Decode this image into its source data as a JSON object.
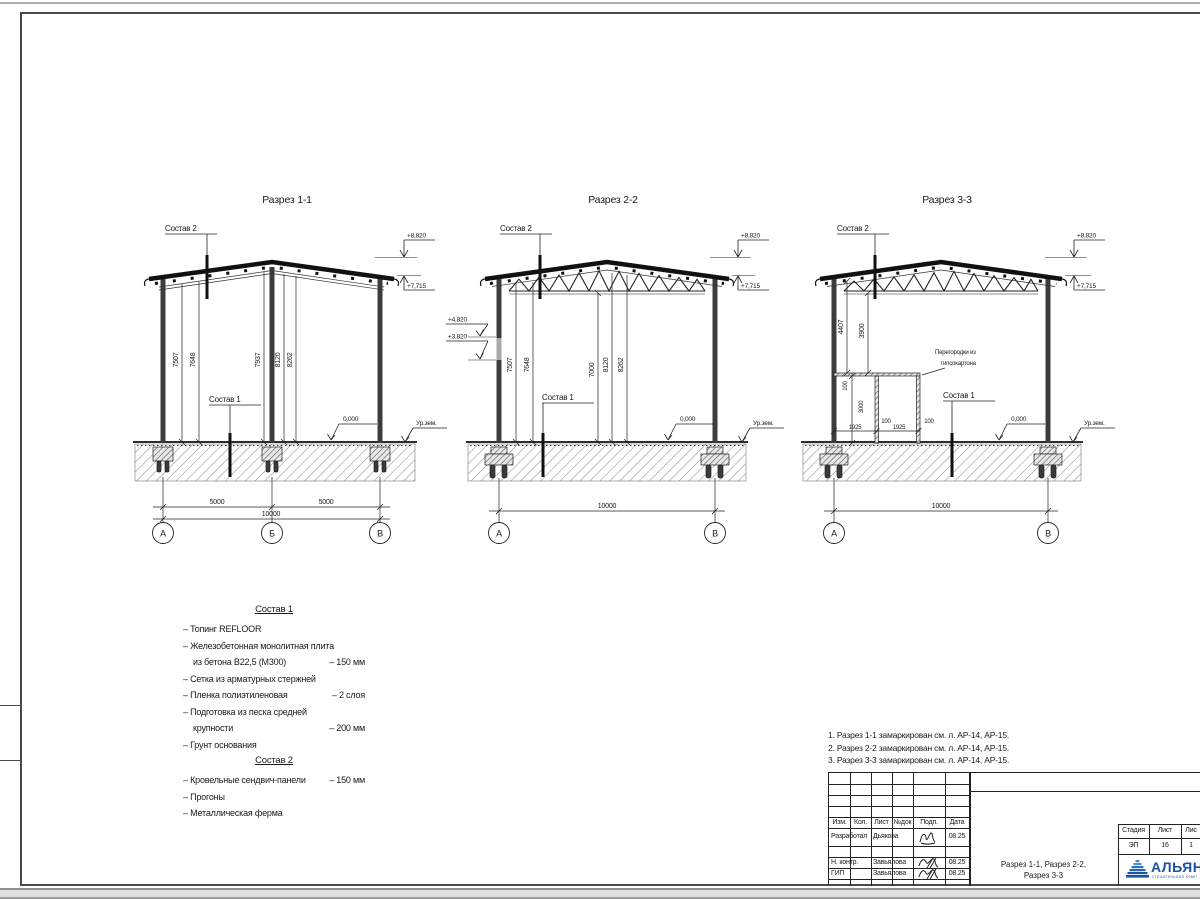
{
  "sheet": {
    "sections": [
      {
        "title": "Разрез 1-1",
        "sostav2": "Состав 2",
        "sostav1": "Состав 1",
        "elev_ridge": "+8,820",
        "elev_eave": "+7,715",
        "elev_floor": "0,000",
        "ground": "Ур.зем.",
        "vdims": [
          "7507",
          "7648",
          "7937",
          "8120",
          "8262"
        ],
        "spans": [
          "5000",
          "5000"
        ],
        "total": "10000",
        "axes": [
          "А",
          "Б",
          "В"
        ]
      },
      {
        "title": "Разрез 2-2",
        "sostav2": "Состав 2",
        "sostav1": "Состав 1",
        "elev_ridge": "+8,820",
        "elev_eave": "+7,715",
        "elev_win_top": "+4,820",
        "elev_win_bot": "+3,820",
        "elev_floor": "0,000",
        "ground": "Ур.зем.",
        "vdims": [
          "7507",
          "7648",
          "7000",
          "8120",
          "8262"
        ],
        "total": "10000",
        "axes": [
          "А",
          "В"
        ]
      },
      {
        "title": "Разрез 3-3",
        "sostav2": "Состав 2",
        "sostav1": "Состав 1",
        "elev_ridge": "+8,820",
        "elev_eave": "+7,715",
        "elev_floor": "0,000",
        "ground": "Ур.зем.",
        "vdims": [
          "4407",
          "3900"
        ],
        "partition": {
          "note1": "Перегородки из",
          "note2": "гипсокартона",
          "v_100": "100",
          "v_3000": "3000",
          "h_1925": "1925",
          "h_100": "100"
        },
        "total": "10000",
        "axes": [
          "А",
          "В"
        ]
      }
    ]
  },
  "legend": {
    "sostav1": {
      "title": "Состав 1",
      "items": [
        {
          "t": "– Топинг REFLOOR",
          "v": ""
        },
        {
          "t": "– Железобетонная  монолитная плита",
          "v": ""
        },
        {
          "t": "из бетона В22,5 (М300)",
          "v": "– 150 мм"
        },
        {
          "t": "– Сетка из арматурных стержней",
          "v": ""
        },
        {
          "t": "– Пленка полиэтиленовая",
          "v": "– 2 слоя"
        },
        {
          "t": "– Подготовка из песка средней",
          "v": ""
        },
        {
          "t": "крупности",
          "v": "– 200 мм"
        },
        {
          "t": "– Грунт основания",
          "v": ""
        }
      ]
    },
    "sostav2": {
      "title": "Состав 2",
      "items": [
        {
          "t": "– Кровельные сендвич-панели",
          "v": "– 150 мм"
        },
        {
          "t": "– Прогоны",
          "v": ""
        },
        {
          "t": "– Металлическая ферма",
          "v": ""
        }
      ]
    }
  },
  "notes": [
    "1. Разрез 1-1 замаркирован см. л. АР-14, АР-15.",
    "2. Разрез 2-2 замаркирован см. л. АР-14, АР-15.",
    "3. Разрез 3-3 замаркирован см. л. АР-14, АР-15."
  ],
  "titleblock": {
    "cols": [
      "Изм.",
      "Кол.",
      "Лист",
      "№док",
      "Подп.",
      "Дата"
    ],
    "rows": [
      {
        "role": "Разработал",
        "name": "Дьякова",
        "date": "08.25"
      },
      {
        "role": "Н. контр.",
        "name": "Завьялова",
        "date": "08.25"
      },
      {
        "role": "ГИП",
        "name": "Завьялова",
        "date": "08.25"
      }
    ],
    "stage_label": "Стадия",
    "sheet_label": "Лист",
    "sheets_label": "Лис",
    "stage": "ЭП",
    "sheet_no": "16",
    "sheets_no": "1",
    "title_line1": "Разрез 1-1, Разрез 2-2,",
    "title_line2": "Разрез 3-3",
    "logo": {
      "name": "АЛЬЯН",
      "sub": "строительная комп",
      "blue": "#1952a5"
    }
  }
}
